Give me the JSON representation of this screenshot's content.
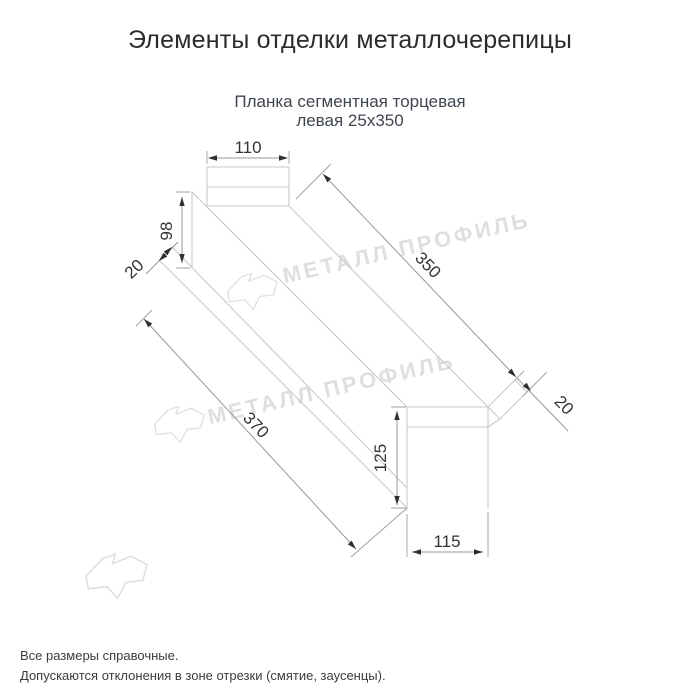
{
  "header": {
    "title": "Элементы отделки металлочерепицы"
  },
  "product": {
    "subtitle_line1": "Планка сегментная торцевая",
    "subtitle_line2": "левая 25х350"
  },
  "drawing": {
    "type": "technical-line-drawing",
    "dims": {
      "top_width": "110",
      "far_height": "98",
      "far_lip": "20",
      "length_total": "370",
      "length_main": "350",
      "near_lip": "20",
      "near_height": "125",
      "near_width": "115"
    },
    "watermark": {
      "text": "МЕТАЛЛ ПРОФИЛЬ",
      "logo": "metall-profil-logo"
    },
    "colors": {
      "outline": "#c9c9c9",
      "dimension_line": "#999999",
      "dimension_text": "#333333",
      "watermark": "#dfdfdf"
    }
  },
  "footer": {
    "note1": "Все размеры справочные.",
    "note2": "Допускаются отклонения в зоне отрезки (смятие, заусенцы)."
  }
}
